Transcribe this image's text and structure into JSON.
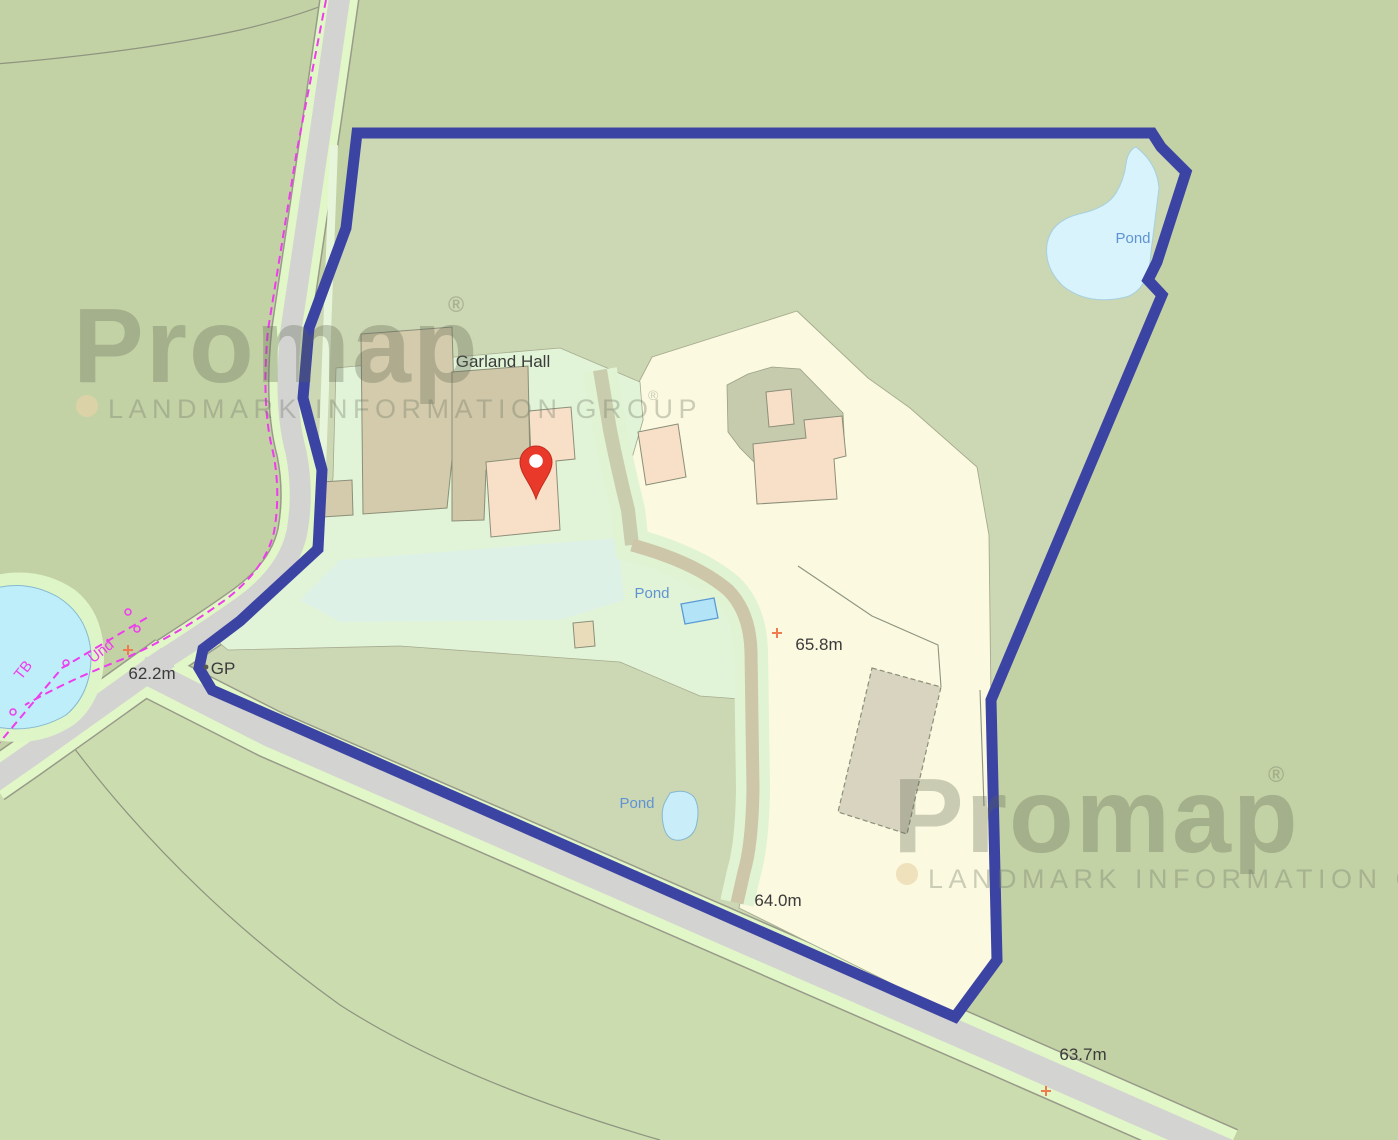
{
  "map": {
    "labels": {
      "property_name": "Garland Hall",
      "pond": "Pond",
      "spot_height_junction": "62.2m",
      "spot_height_mid": "65.8m",
      "spot_height_drive": "64.0m",
      "spot_height_road": "63.7m",
      "guide_post": "GP",
      "telephone_box": "TB",
      "undefined_boundary": "Und"
    },
    "watermark": {
      "brand": "Promap",
      "registered": "®",
      "caption": "LANDMARK INFORMATION GROUP"
    },
    "colors": {
      "boundary": "#3c44a3",
      "pin": "#e8392b",
      "pin_hole": "#ffffff",
      "outside_green": "#c3d2a5",
      "outside_green_bottom": "#cbdcae",
      "interior_green": "#ccd7b3",
      "pale_yellow": "#fbf9df",
      "mint": "#e2f4d7",
      "mint_cyan": "#ddf1e6",
      "road_gray": "#d3d3d2",
      "verge_green": "#e2f7c7",
      "road_edge": "#989a8a",
      "pond_left": "#bfeefb",
      "pond_top_right": "#d8f3fb",
      "pond_small": "#b3e3f7",
      "building_tan": "#d3cbab",
      "building_peach": "#f8dfc8",
      "barn_gray": "#d8d4c0",
      "courtyard": "#c6cbae",
      "driveway_tan": "#cdc6a8",
      "driveway_gray": "#c9cdae",
      "magenta": "#ee3cee",
      "orange_marker": "#ef7c50",
      "label_dark": "#3b3b3b",
      "label_blue": "#5f93d2",
      "watermark_gray": "#5a6350",
      "watermark_dot": "#e8d4a8"
    }
  }
}
